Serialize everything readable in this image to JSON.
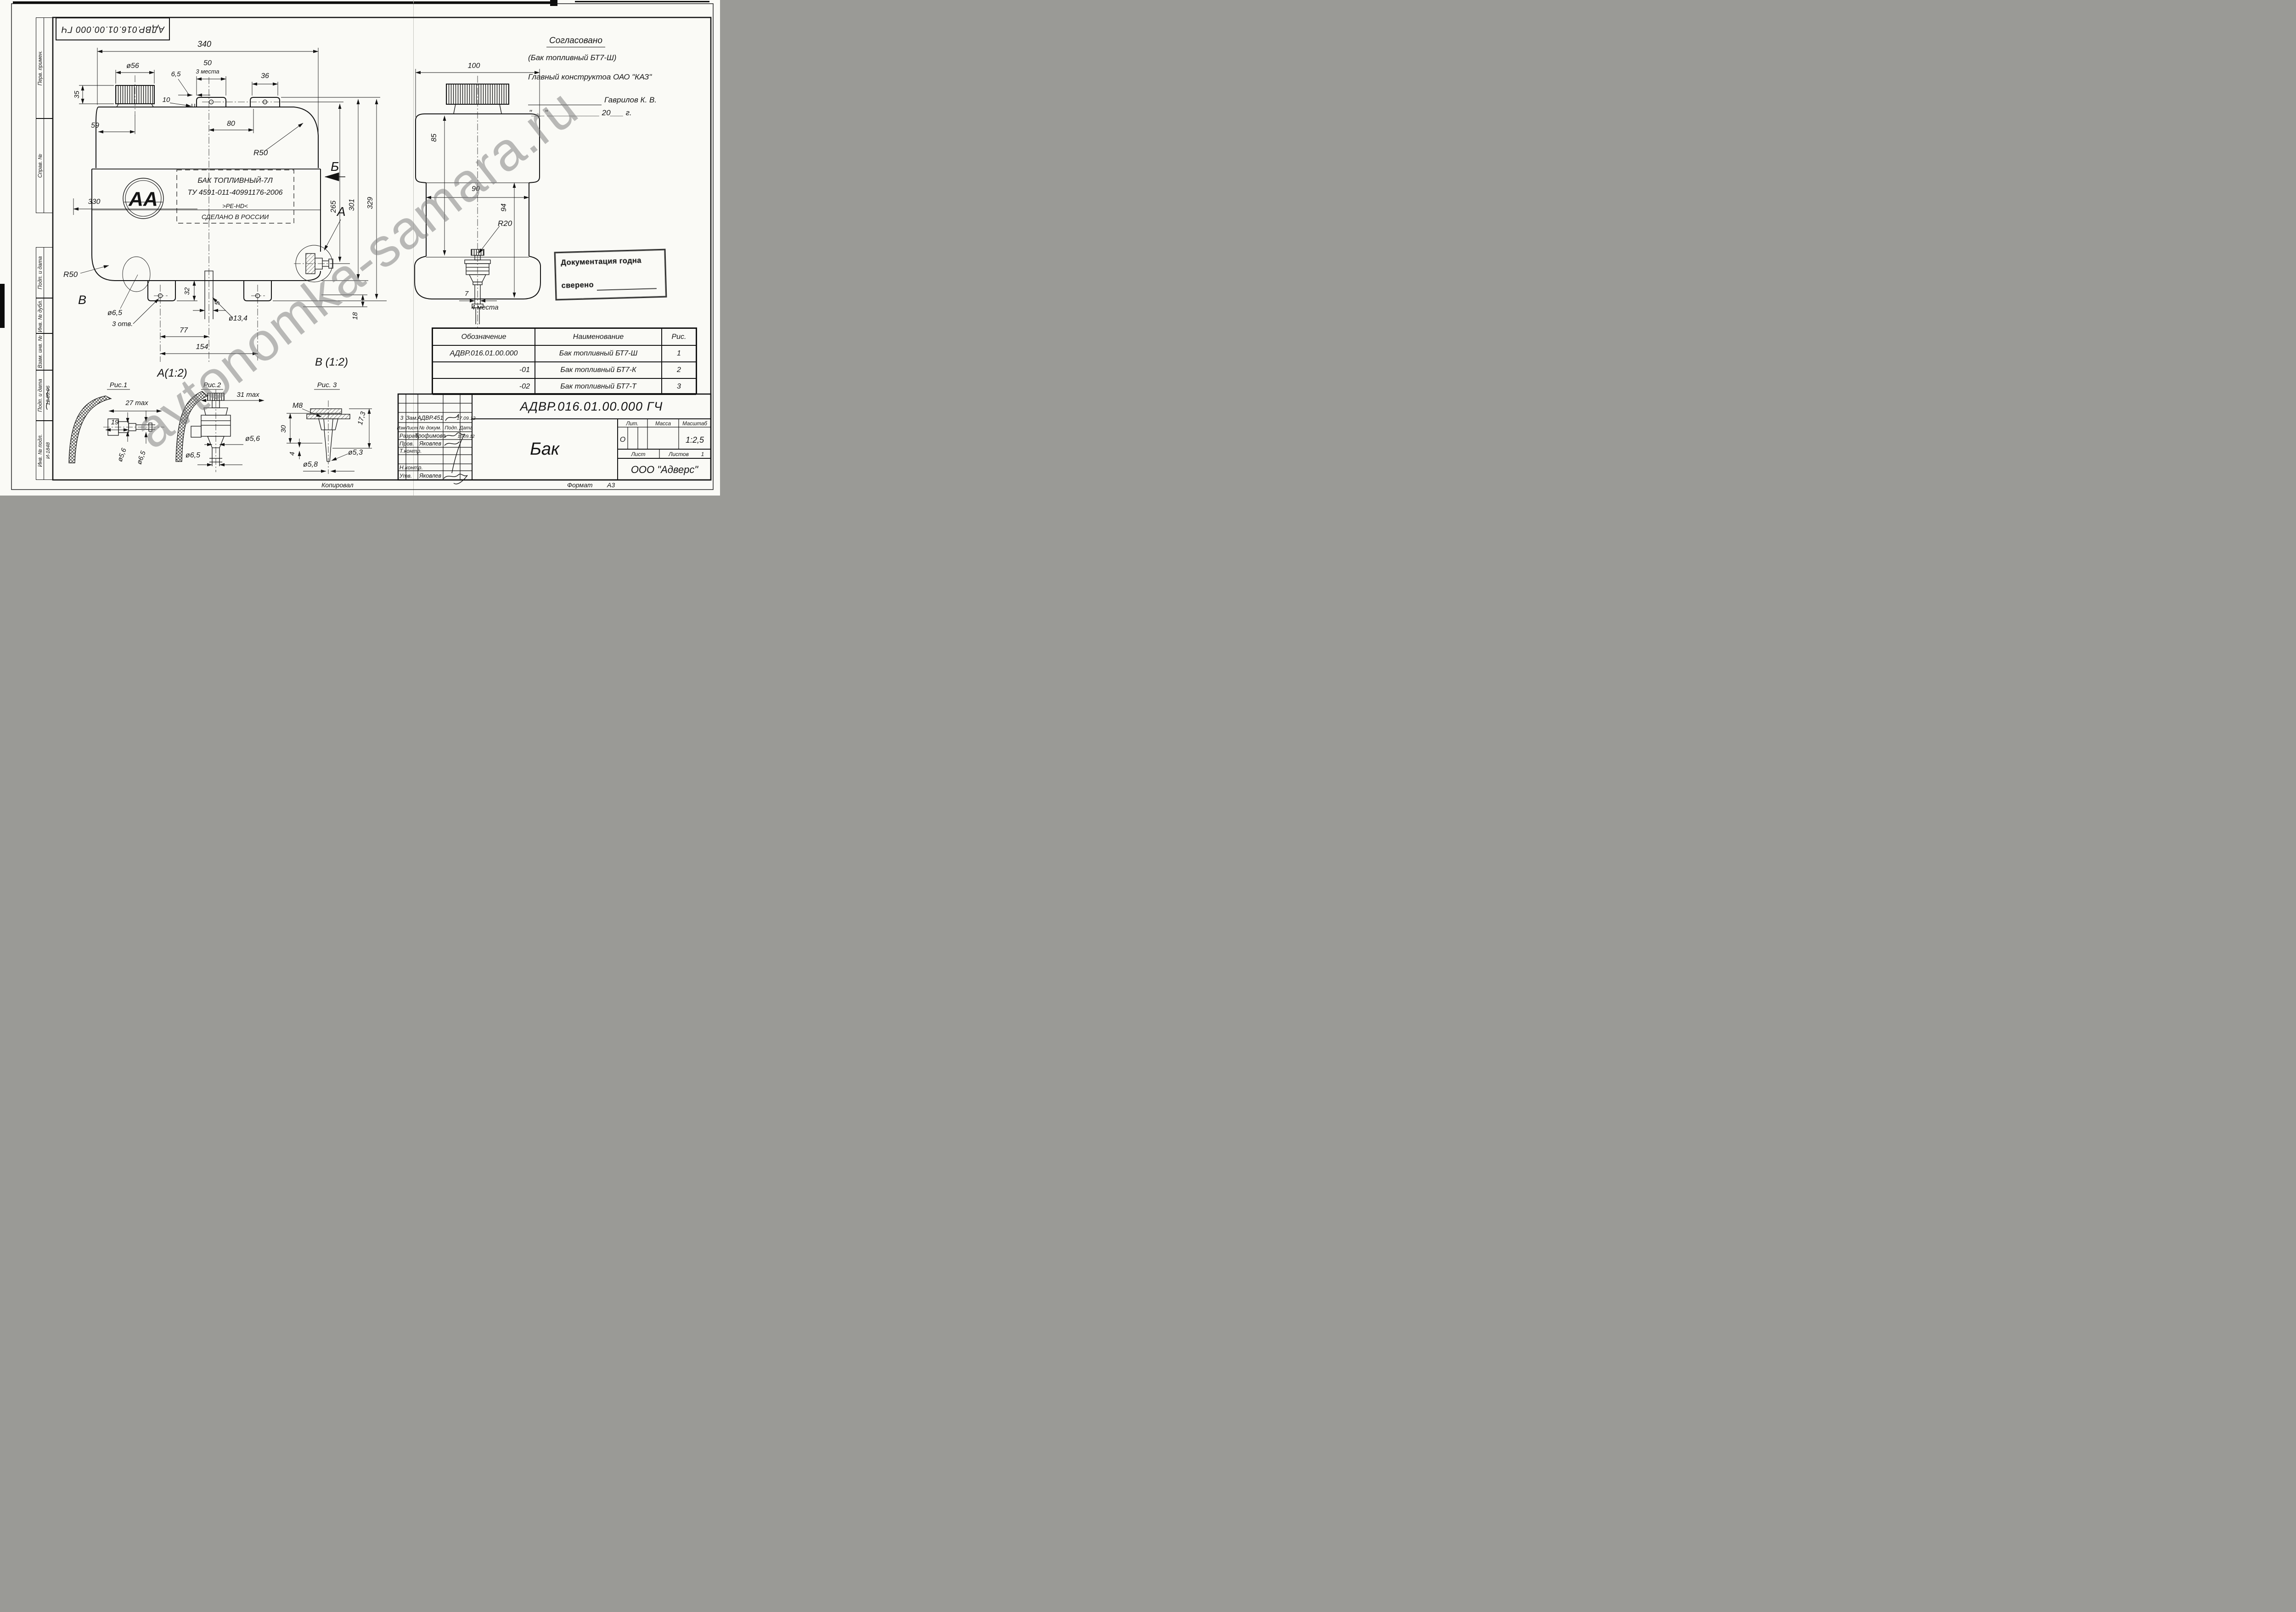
{
  "watermark": "avtonomka-samara.ru",
  "corner_code": "АДВР.016.01.00.000 ГЧ",
  "margin": {
    "perv": "Перв. примен.",
    "sprav": "Справ. №",
    "podp1": "Подп. и дата",
    "inv_dubl": "Инв. № дубл.",
    "vzam": "Взам. инв. №",
    "podp2": "Подп. и дата",
    "inv_podl": "Инв. № подл.",
    "date_note": "12.09.06",
    "inv_number": "И-1848"
  },
  "approval": {
    "title": "Согласовано",
    "product": "(Бак топливный БТ7-Ш)",
    "chief": "Главный конструктоа ОАО \"КАЗ\"",
    "name": "Гаврилов К. В.",
    "date_line": "\"___\"____________ 20___ г."
  },
  "front": {
    "d340": "340",
    "d56": "ø56",
    "d50": "50",
    "places3": "3 места",
    "d36": "36",
    "d65top": "6,5",
    "d10": "10",
    "d80": "80",
    "r50top": "R50",
    "d35": "35",
    "d59": "59",
    "d330": "330",
    "r50bot": "R50",
    "sectionB": "В",
    "d65bot": "ø6,5",
    "holes3": "3 отв.",
    "d32": "32",
    "d5": "5",
    "d134": "ø13,4",
    "d77": "77",
    "d154": "154",
    "d18": "18",
    "d265": "265",
    "d301": "301",
    "d329": "329",
    "viewB": "Б",
    "viewA": "А",
    "logo": "АА",
    "label1": "БАК ТОПЛИВНЫЙ-7Л",
    "label2": "ТУ 4591-011-40991176-2006",
    "label3": ">PE-HD<",
    "label4": "СДЕЛАНО В РОССИИ"
  },
  "side": {
    "d100": "100",
    "d85": "85",
    "d90": "90",
    "d94": "94",
    "r20": "R20",
    "d7": "7",
    "places4": "4 места"
  },
  "details": {
    "a_title": "А(1:2)",
    "fig1": "Рис.1",
    "d27": "27 max",
    "d19": "19",
    "d56": "ø5,6",
    "d65": "ø6,5",
    "fig2": "Рис.2",
    "d31": "31 max",
    "d56b": "ø5,6",
    "d65b": "ø6,5",
    "v_title": "В (1:2)",
    "fig3": "Рис. 3",
    "m8": "M8",
    "d30": "30",
    "d173": "17,3",
    "d4": "4",
    "d58": "ø5,8",
    "d53": "ø5,3"
  },
  "stamp": {
    "line1": "Документация годна",
    "line2": "сверено"
  },
  "spec_table": {
    "headers": [
      "Обозначение",
      "Наименование",
      "Рис."
    ],
    "rows": [
      {
        "code": "АДВР.016.01.00.000",
        "name": "Бак топливный БТ7-Ш",
        "fig": "1"
      },
      {
        "code": "-01",
        "name": "Бак топливный БТ7-К",
        "fig": "2"
      },
      {
        "code": "-02",
        "name": "Бак топливный БТ7-Т",
        "fig": "3"
      }
    ]
  },
  "title_block": {
    "designation": "АДВР.016.01.00.000 ГЧ",
    "rev": {
      "num": "3",
      "kind": "Зам.",
      "doc": "АДВР.451",
      "date": "17.09.12"
    },
    "cols": {
      "izm": "Изм.",
      "list": "Лист",
      "doc": "№ докум.",
      "podp": "Подп.",
      "data": "Дата"
    },
    "rows": {
      "razrab": "Разраб.",
      "razrab_name": "Трофимова",
      "razrab_date": "10.09.12",
      "prov": "Пров.",
      "prov_name": "Яковлев",
      "tkontr": "Т.контр.",
      "nkontr": "Н.контр.",
      "utv": "Утв.",
      "utv_name": "Яковлев"
    },
    "name": "Бак",
    "lit": "Лит.",
    "lit_val": "О",
    "massa": "Масса",
    "masshtab": "Масштаб",
    "scale": "1:2,5",
    "list_label": "Лист",
    "listov_label": "Листов",
    "listov_val": "1",
    "company": "ООО \"Адверс\""
  },
  "footer": {
    "copied": "Копировал",
    "format_label": "Формат",
    "format_val": "А3"
  }
}
